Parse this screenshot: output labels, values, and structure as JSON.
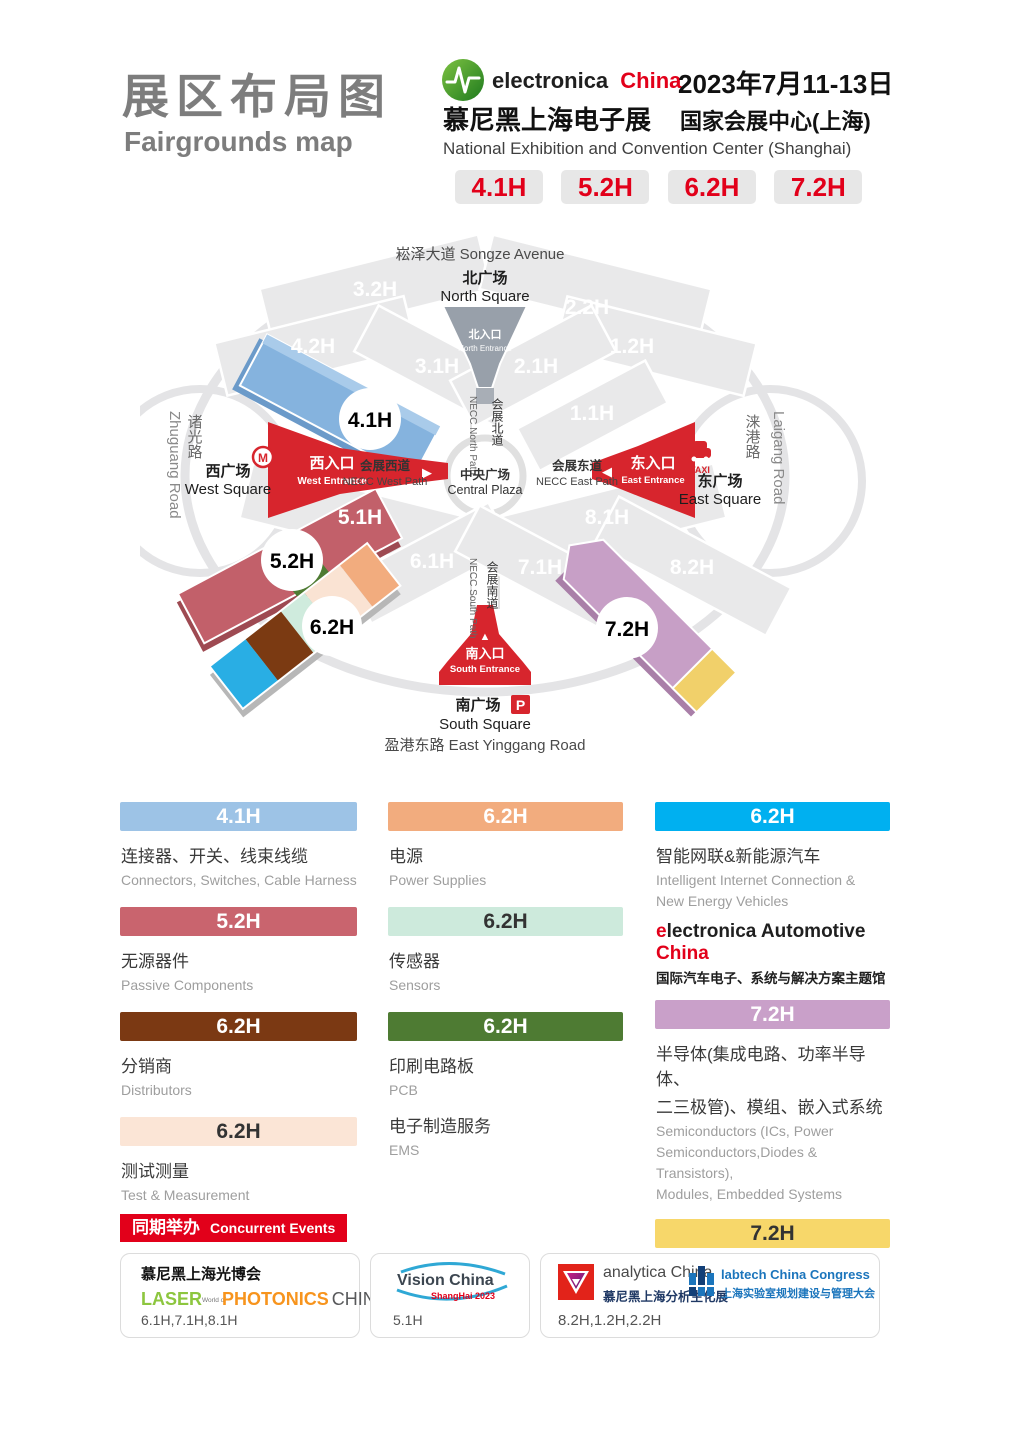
{
  "colors": {
    "brand_red": "#E2001A",
    "title_gray": "#7D7D7D",
    "entrance_red": "#D7252D",
    "hall_blue": "#9DC3E6",
    "hall_rose": "#C9646E",
    "hall_brown": "#7B3913",
    "hall_cream": "#FBE5D6",
    "hall_orange": "#F2AC7E",
    "hall_mint": "#CDEADC",
    "hall_green": "#4E7B33",
    "hall_cyan": "#00B0F0",
    "hall_mauve": "#C9A0C9",
    "hall_yellow": "#F7D76A"
  },
  "header": {
    "title_cn": "展区布局图",
    "title_en": "Fairgrounds map",
    "brand_black": "electronica",
    "brand_red_word": "China",
    "brand_cn": "慕尼黑上海电子展",
    "date": "2023年7月11-13日",
    "venue_cn": "国家会展中心(上海)",
    "venue_en": "National Exhibition and Convention Center (Shanghai)",
    "badges": [
      "4.1H",
      "5.2H",
      "6.2H",
      "7.2H"
    ]
  },
  "map": {
    "songze": "崧泽大道 Songze Avenue",
    "north_square_cn": "北广场",
    "north_square_en": "North Square",
    "north_entrance_cn": "北入口",
    "north_entrance_en": "North Entrance",
    "necc_north_cn": "会展北道",
    "necc_north_en": "NECC North Path",
    "central_cn": "中央广场",
    "central_en": "Central Plaza",
    "necc_west_cn": "会展西道",
    "necc_west_en": "NECC West Path",
    "necc_east_cn": "会展东道",
    "necc_east_en": "NECC East Path",
    "necc_south_cn": "会展南道",
    "necc_south_en": "NECC South Path",
    "west_entrance_cn": "西入口",
    "west_entrance_en": "West Entrance",
    "west_square_cn": "西广场",
    "west_square_en": "West Square",
    "east_entrance_cn": "东入口",
    "east_entrance_en": "East Entrance",
    "east_square_cn": "东广场",
    "east_square_en": "East Square",
    "south_entrance_cn": "南入口",
    "south_entrance_en": "South Entrance",
    "south_square_cn": "南广场",
    "south_square_en": "South Square",
    "yinggang": "盈港东路 East Yinggang Road",
    "zhuguang_cn": "诸光路",
    "zhuguang_en": "Zhuguang Road",
    "laigang_cn": "涞港路",
    "laigang_en": "Laigang Road",
    "taxi": "TAXI",
    "parking": "P",
    "halls": {
      "h32": "3.2H",
      "h42": "4.2H",
      "h31": "3.1H",
      "h22": "2.2H",
      "h21": "2.1H",
      "h12": "1.2H",
      "h11": "1.1H",
      "h51": "5.1H",
      "h61": "6.1H",
      "h71": "7.1H",
      "h81": "8.1H",
      "h82": "8.2H",
      "h41": "4.1H",
      "h52": "5.2H",
      "h62": "6.2H",
      "h72": "7.2H"
    }
  },
  "legend": {
    "col1": [
      {
        "hall": "4.1H",
        "style": "background:#9DC3E6;color:#fff",
        "cn": "连接器、开关、线束线缆",
        "en": "Connectors, Switches, Cable Harness"
      },
      {
        "hall": "5.2H",
        "style": "background:#C9646E;color:#fff",
        "cn": "无源器件",
        "en": "Passive Components"
      },
      {
        "hall": "6.2H",
        "style": "background:#7B3913;color:#fff",
        "cn": "分销商",
        "en": "Distributors"
      },
      {
        "hall": "6.2H",
        "style": "background:#FBE5D6;color:#333",
        "cn": "测试测量",
        "en": "Test & Measurement"
      }
    ],
    "col2": [
      {
        "hall": "6.2H",
        "style": "background:#F2AC7E;color:#fff",
        "cn": "电源",
        "en": "Power Supplies"
      },
      {
        "hall": "6.2H",
        "style": "background:#CDEADC;color:#333",
        "cn": "传感器",
        "en": "Sensors"
      },
      {
        "hall": "6.2H",
        "style": "background:#4E7B33;color:#fff",
        "cn": "印刷电路板",
        "en": "PCB",
        "cn2": "电子制造服务",
        "en2": "EMS"
      }
    ],
    "col3": [
      {
        "hall": "6.2H",
        "style": "background:#00B0F0;color:#fff",
        "cn": "智能网联&新能源汽车",
        "en1": "Intelligent Internet Connection &",
        "en2": "New Energy Vehicles"
      },
      {
        "hall": "7.2H",
        "style": "background:#C9A0C9;color:#fff",
        "cn1": "半导体(集成电路、功率半导体、",
        "cn2": "二三极管)、模组、嵌入式系统",
        "en1": "Semiconductors (ICs, Power",
        "en2": "Semiconductors,Diodes & Transistors),",
        "en3": "Modules, Embedded Systems"
      },
      {
        "hall": "7.2H",
        "style": "background:#F7D76A;color:#333",
        "cn": "先进制造",
        "en": "Advanced manufacturing"
      }
    ],
    "automotive": {
      "e": "e",
      "rest": "lectronica Automotive",
      "china": "China",
      "cn": "国际汽车电子、系统与解决方案主题馆"
    }
  },
  "events": {
    "banner_cn": "同期举办",
    "banner_en": "Concurrent Events",
    "card1": {
      "cn": "慕尼黑上海光博会",
      "laser": "LASER",
      "world": "World of",
      "photonics": "PHOTONICS",
      "china": "CHINA",
      "halls": "6.1H,7.1H,8.1H"
    },
    "card2": {
      "name": "Vision China",
      "sub": "ShangHai 2023",
      "halls": "5.1H"
    },
    "card3": {
      "analytica": "analytica China",
      "analytica_cn": "慕尼黑上海分析生化展",
      "labtech": "labtech China Congress",
      "labtech_cn": "上海实验室规划建设与管理大会",
      "halls": "8.2H,1.2H,2.2H"
    }
  }
}
